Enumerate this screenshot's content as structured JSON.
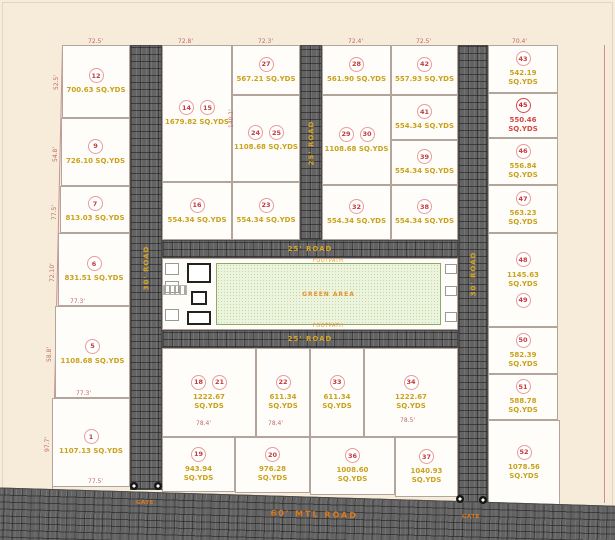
{
  "title": "plot-layout-site-plan",
  "colors": {
    "background": "#f6ecd9",
    "plot_fill": "#fffdf9",
    "road_fill": "#636363",
    "road_label": "#d8a625",
    "bottom_road_label": "#e07818",
    "plot_number": "#c23a3a",
    "area_text": "#c9a21d",
    "highlight_area_text": "#d34848",
    "lawn_fill": "#edf4de",
    "dimension_text": "#bf6a6a"
  },
  "amenity": {
    "lawn_label": "GREEN AREA",
    "footpath_top": "FOOTPATH",
    "footpath_bottom": "FOOTPATH"
  },
  "roads": [
    {
      "name": "road-left-vertical",
      "label": "30' ROAD",
      "vert": true,
      "x": 130,
      "y": 45,
      "w": 32,
      "h": 445
    },
    {
      "name": "road-middle-vertical",
      "label": "25' ROAD",
      "vert": true,
      "x": 300,
      "y": 45,
      "w": 22,
      "h": 195
    },
    {
      "name": "road-right-vertical",
      "label": "30' ROAD",
      "vert": true,
      "x": 458,
      "y": 45,
      "w": 30,
      "h": 458
    },
    {
      "name": "road-amenity-top",
      "label": "25' ROAD",
      "vert": false,
      "x": 162,
      "y": 240,
      "w": 296,
      "h": 18
    },
    {
      "name": "road-amenity-bottom",
      "label": "25' ROAD",
      "vert": false,
      "x": 162,
      "y": 330,
      "w": 296,
      "h": 18
    },
    {
      "name": "road-bottom-main",
      "label": "60' MTL ROAD",
      "vert": false,
      "x": -15,
      "y": 487,
      "w": 660,
      "h": 58,
      "rot": 1.7,
      "big": true
    }
  ],
  "plots": [
    {
      "numbers": [
        "12"
      ],
      "area": "700.63 SQ.YDS",
      "x": 62,
      "y": 45,
      "w": 68,
      "h": 73
    },
    {
      "numbers": [
        "9"
      ],
      "area": "726.10 SQ.YDS",
      "x": 61,
      "y": 118,
      "w": 69,
      "h": 68
    },
    {
      "numbers": [
        "7"
      ],
      "area": "813.03 SQ.YDS",
      "x": 60,
      "y": 186,
      "w": 70,
      "h": 47
    },
    {
      "numbers": [
        "6"
      ],
      "area": "831.51 SQ.YDS",
      "x": 58,
      "y": 233,
      "w": 72,
      "h": 73
    },
    {
      "numbers": [
        "5"
      ],
      "area": "1108.68 SQ.YDS",
      "x": 55,
      "y": 306,
      "w": 75,
      "h": 92
    },
    {
      "numbers": [
        "1"
      ],
      "area": "1107.13 SQ.YDS",
      "x": 52,
      "y": 398,
      "w": 78,
      "h": 89
    },
    {
      "numbers": [
        "14",
        "15"
      ],
      "area": "1679.82 SQ.YDS",
      "x": 162,
      "y": 45,
      "w": 70,
      "h": 137
    },
    {
      "numbers": [
        "16"
      ],
      "area": "554.34 SQ.YDS",
      "x": 162,
      "y": 182,
      "w": 70,
      "h": 58
    },
    {
      "numbers": [
        "27"
      ],
      "area": "567.21 SQ.YDS",
      "x": 232,
      "y": 45,
      "w": 68,
      "h": 50
    },
    {
      "numbers": [
        "24",
        "25"
      ],
      "area": "1108.68 SQ.YDS",
      "x": 232,
      "y": 95,
      "w": 68,
      "h": 87
    },
    {
      "numbers": [
        "23"
      ],
      "area": "554.34 SQ.YDS",
      "x": 232,
      "y": 182,
      "w": 68,
      "h": 58
    },
    {
      "numbers": [
        "28"
      ],
      "area": "561.90 SQ.YDS",
      "x": 322,
      "y": 45,
      "w": 69,
      "h": 50
    },
    {
      "numbers": [
        "29",
        "30"
      ],
      "area": "1108.68 SQ.YDS",
      "x": 322,
      "y": 95,
      "w": 69,
      "h": 90
    },
    {
      "numbers": [
        "32"
      ],
      "area": "554.34 SQ.YDS",
      "x": 322,
      "y": 185,
      "w": 69,
      "h": 55
    },
    {
      "numbers": [
        "42"
      ],
      "area": "557.93 SQ.YDS",
      "x": 391,
      "y": 45,
      "w": 67,
      "h": 50
    },
    {
      "numbers": [
        "41"
      ],
      "area": "554.34 SQ.YDS",
      "x": 391,
      "y": 95,
      "w": 67,
      "h": 45
    },
    {
      "numbers": [
        "39"
      ],
      "area": "554.34 SQ.YDS",
      "x": 391,
      "y": 140,
      "w": 67,
      "h": 45
    },
    {
      "numbers": [
        "38"
      ],
      "area": "554.34 SQ.YDS",
      "x": 391,
      "y": 185,
      "w": 67,
      "h": 55
    },
    {
      "numbers": [
        "43"
      ],
      "area": "542.19 SQ.YDS",
      "x": 488,
      "y": 45,
      "w": 70,
      "h": 48,
      "wrap": true
    },
    {
      "numbers": [
        "45"
      ],
      "area": "550.46 SQ.YDS",
      "x": 488,
      "y": 93,
      "w": 70,
      "h": 45,
      "wrap": true,
      "red": true
    },
    {
      "numbers": [
        "46"
      ],
      "area": "556.84 SQ.YDS",
      "x": 488,
      "y": 138,
      "w": 70,
      "h": 47,
      "wrap": true
    },
    {
      "numbers": [
        "47"
      ],
      "area": "563.23 SQ.YDS",
      "x": 488,
      "y": 185,
      "w": 70,
      "h": 48,
      "wrap": true
    },
    {
      "numbers": [
        "48",
        "49"
      ],
      "area": "1145.63 SQ.YDS",
      "x": 488,
      "y": 233,
      "w": 70,
      "h": 94,
      "wrap": true,
      "stacked": true
    },
    {
      "numbers": [
        "50"
      ],
      "area": "582.39 SQ.YDS",
      "x": 488,
      "y": 327,
      "w": 70,
      "h": 47,
      "wrap": true
    },
    {
      "numbers": [
        "51"
      ],
      "area": "588.78 SQ.YDS",
      "x": 488,
      "y": 374,
      "w": 70,
      "h": 46,
      "wrap": true
    },
    {
      "numbers": [
        "52"
      ],
      "area": "1078.56 SQ.YDS",
      "x": 488,
      "y": 420,
      "w": 72,
      "h": 85,
      "wrap": true
    },
    {
      "numbers": [
        "18",
        "21"
      ],
      "area": "1222.67 SQ.YDS",
      "x": 162,
      "y": 348,
      "w": 94,
      "h": 89,
      "wrap": true
    },
    {
      "numbers": [
        "22"
      ],
      "area": "611.34 SQ.YDS",
      "x": 256,
      "y": 348,
      "w": 54,
      "h": 89,
      "wrap": true
    },
    {
      "numbers": [
        "33"
      ],
      "area": "611.34 SQ.YDS",
      "x": 310,
      "y": 348,
      "w": 54,
      "h": 89,
      "wrap": true
    },
    {
      "numbers": [
        "34"
      ],
      "area": "1222.67 SQ.YDS",
      "x": 364,
      "y": 348,
      "w": 94,
      "h": 89,
      "wrap": true
    },
    {
      "numbers": [
        "19"
      ],
      "area": "943.94 SQ.YDS",
      "x": 162,
      "y": 437,
      "w": 73,
      "h": 55,
      "wrap": true
    },
    {
      "numbers": [
        "20"
      ],
      "area": "976.28 SQ.YDS",
      "x": 235,
      "y": 437,
      "w": 75,
      "h": 56,
      "wrap": true
    },
    {
      "numbers": [
        "36"
      ],
      "area": "1008.60 SQ.YDS",
      "x": 310,
      "y": 437,
      "w": 85,
      "h": 58,
      "wrap": true
    },
    {
      "numbers": [
        "37"
      ],
      "area": "1040.93 SQ.YDS",
      "x": 395,
      "y": 437,
      "w": 63,
      "h": 60,
      "wrap": true
    }
  ],
  "dimensions": [
    {
      "t": "72.5'",
      "x": 88,
      "y": 38
    },
    {
      "t": "72.8'",
      "x": 178,
      "y": 38
    },
    {
      "t": "72.3'",
      "x": 258,
      "y": 38
    },
    {
      "t": "72.4'",
      "x": 348,
      "y": 38
    },
    {
      "t": "72.5'",
      "x": 416,
      "y": 38
    },
    {
      "t": "70.4'",
      "x": 512,
      "y": 38
    },
    {
      "t": "52.5'",
      "x": 53,
      "y": 90,
      "r": true
    },
    {
      "t": "54.8'",
      "x": 52,
      "y": 162,
      "r": true
    },
    {
      "t": "77.5'",
      "x": 51,
      "y": 220,
      "r": true
    },
    {
      "t": "72.10'",
      "x": 49,
      "y": 282,
      "r": true
    },
    {
      "t": "58.8'",
      "x": 46,
      "y": 362,
      "r": true
    },
    {
      "t": "97.7'",
      "x": 44,
      "y": 452,
      "r": true
    },
    {
      "t": "140.1'",
      "x": 228,
      "y": 128,
      "r": true
    },
    {
      "t": "77.3'",
      "x": 70,
      "y": 298
    },
    {
      "t": "77.3'",
      "x": 76,
      "y": 390
    },
    {
      "t": "77.5'",
      "x": 88,
      "y": 478
    },
    {
      "t": "78.4'",
      "x": 196,
      "y": 420
    },
    {
      "t": "78.4'",
      "x": 268,
      "y": 420
    },
    {
      "t": "78.5'",
      "x": 400,
      "y": 417
    }
  ],
  "gates": {
    "posts": [
      {
        "x": 130,
        "y": 482
      },
      {
        "x": 154,
        "y": 482
      },
      {
        "x": 456,
        "y": 495
      },
      {
        "x": 479,
        "y": 496
      }
    ],
    "labels": [
      {
        "t": "GATE",
        "x": 136,
        "y": 500
      },
      {
        "t": "GATE",
        "x": 462,
        "y": 514
      }
    ]
  },
  "boundary_lines": [
    {
      "x": 604,
      "y": 45,
      "w": 1,
      "h": 458,
      "rot": 0
    },
    {
      "x": 62,
      "y": 45,
      "w": 1,
      "h": 444,
      "rot": 1.3
    }
  ]
}
